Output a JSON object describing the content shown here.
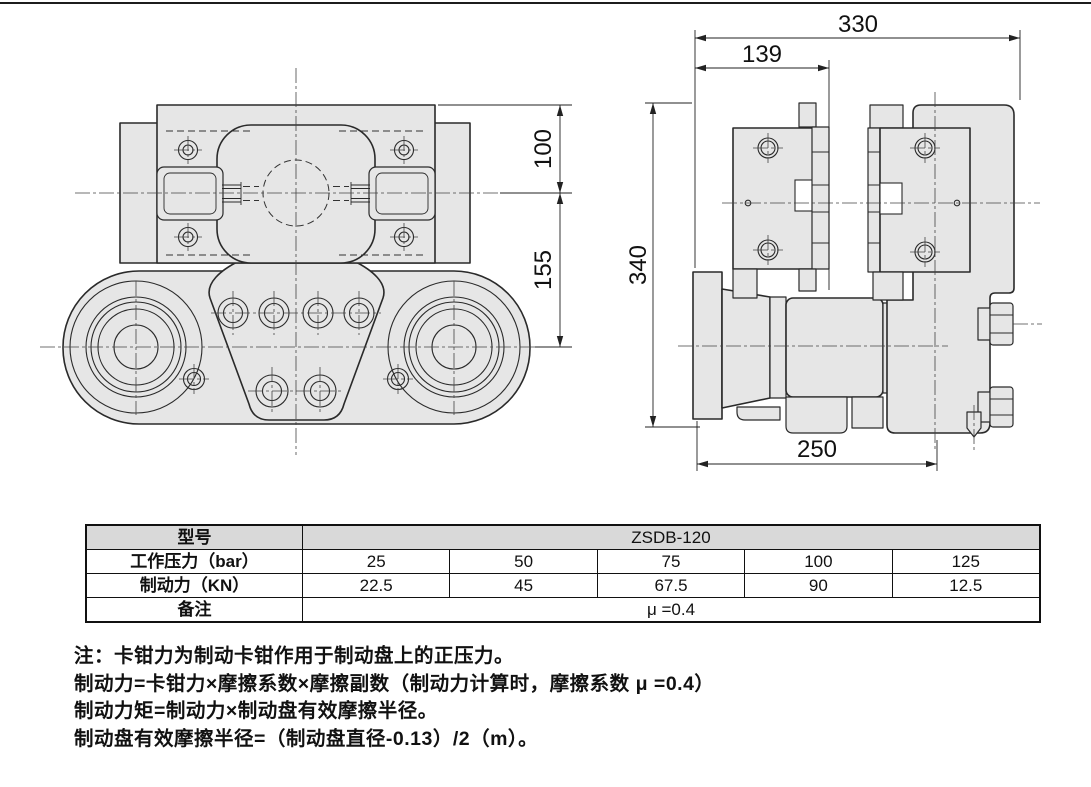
{
  "drawing": {
    "front_view": {
      "dim_100": "100",
      "dim_155": "155"
    },
    "side_view": {
      "dim_330": "330",
      "dim_139": "139",
      "dim_340": "340",
      "dim_250": "250"
    }
  },
  "table": {
    "model_label": "型号",
    "model_value": "ZSDB-120",
    "pressure_label": "工作压力（bar）",
    "pressure_values": [
      "25",
      "50",
      "75",
      "100",
      "125"
    ],
    "force_label": "制动力（KN）",
    "force_values": [
      "22.5",
      "45",
      "67.5",
      "90",
      "12.5"
    ],
    "remark_label": "备注",
    "remark_value": "μ =0.4"
  },
  "notes": {
    "line1": "注：卡钳力为制动卡钳作用于制动盘上的正压力。",
    "line2": "制动力=卡钳力×摩擦系数×摩擦副数（制动力计算时，摩擦系数 μ =0.4）",
    "line3": "制动力矩=制动力×制动盘有效摩擦半径。",
    "line4": "制动盘有效摩擦半径=（制动盘直径-0.13）/2（m）。"
  },
  "colors": {
    "part_fill": "#e6e6e6",
    "line": "#2a2a2a",
    "table_header_bg": "#d9d9d9"
  }
}
